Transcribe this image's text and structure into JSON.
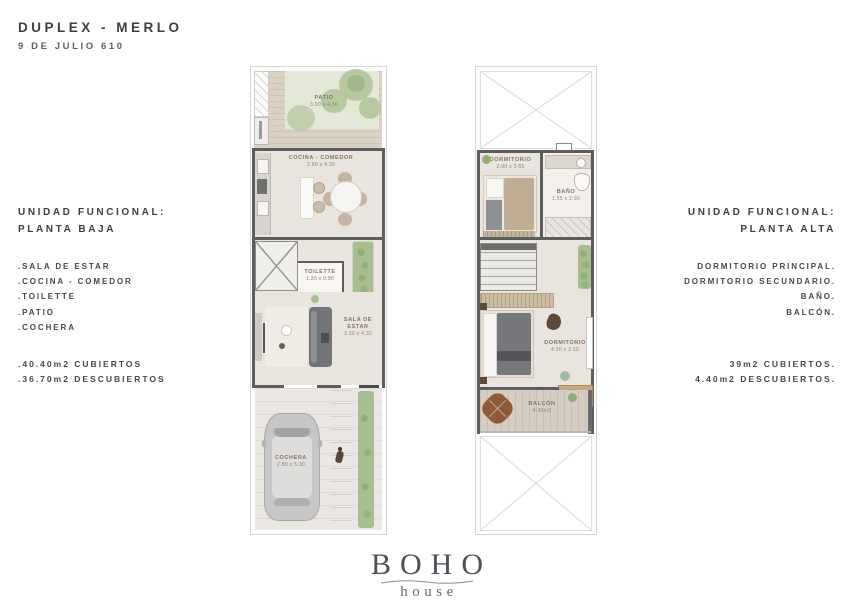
{
  "header": {
    "title": "DUPLEX - MERLO",
    "subtitle": "9 DE JULIO 610"
  },
  "left_info": {
    "heading_line1": "UNIDAD FUNCIONAL:",
    "heading_line2": "PLANTA BAJA",
    "items": [
      ".SALA DE ESTAR",
      ".COCINA - COMEDOR",
      ".TOILETTE",
      ".PATIO",
      ".COCHERA"
    ],
    "area_line1": ".40.40m2 CUBIERTOS",
    "area_line2": ".36.70m2 DESCUBIERTOS"
  },
  "right_info": {
    "heading_line1": "UNIDAD FUNCIONAL:",
    "heading_line2": "PLANTA ALTA",
    "items": [
      "DORMITORIO PRINCIPAL.",
      "DORMITORIO SECUNDARIO.",
      "BAÑO.",
      "BALCÓN."
    ],
    "area_line1": "39m2 CUBIERTOS.",
    "area_line2": "4.40m2 DESCUBIERTOS."
  },
  "plan_baja": {
    "patio": {
      "name": "PATIO",
      "dims": "3.00 x 4.30"
    },
    "cocina": {
      "name": "COCINA - COMEDOR",
      "dims": "2.90 x 4.30"
    },
    "toilette": {
      "name": "TOILETTE",
      "dims": "1.30 x 0.90"
    },
    "sala": {
      "name_line1": "SALA DE",
      "name_line2": "ESTAR",
      "dims": "3.30 x 4.30"
    },
    "cochera": {
      "name": "COCHERA",
      "dims": "2.80 x 5.30"
    }
  },
  "plan_alta": {
    "dormitorio_secundario": {
      "name": "DORMITORIO",
      "dims": "2.90 x 2.65"
    },
    "bano": {
      "name": "BAÑO",
      "dims": "1.55 x 2.90"
    },
    "dormitorio_principal": {
      "name": "DORMITORIO",
      "dims": "4.30 x 3.50"
    },
    "balcon": {
      "name": "BALCÓN",
      "dims": "4.40m2"
    }
  },
  "logo": {
    "text": "BOHO",
    "sub": "house"
  },
  "colors": {
    "wall": "#5d5d5d",
    "floor": "#e9e4dd",
    "deck": "#d9cfc1",
    "greenery": "#a9bd92",
    "dark_furniture": "#75767a",
    "wood": "#c9a87f",
    "poof": "#8f5a39",
    "heading_text": "#3a3f44",
    "room_label": "#807664"
  }
}
